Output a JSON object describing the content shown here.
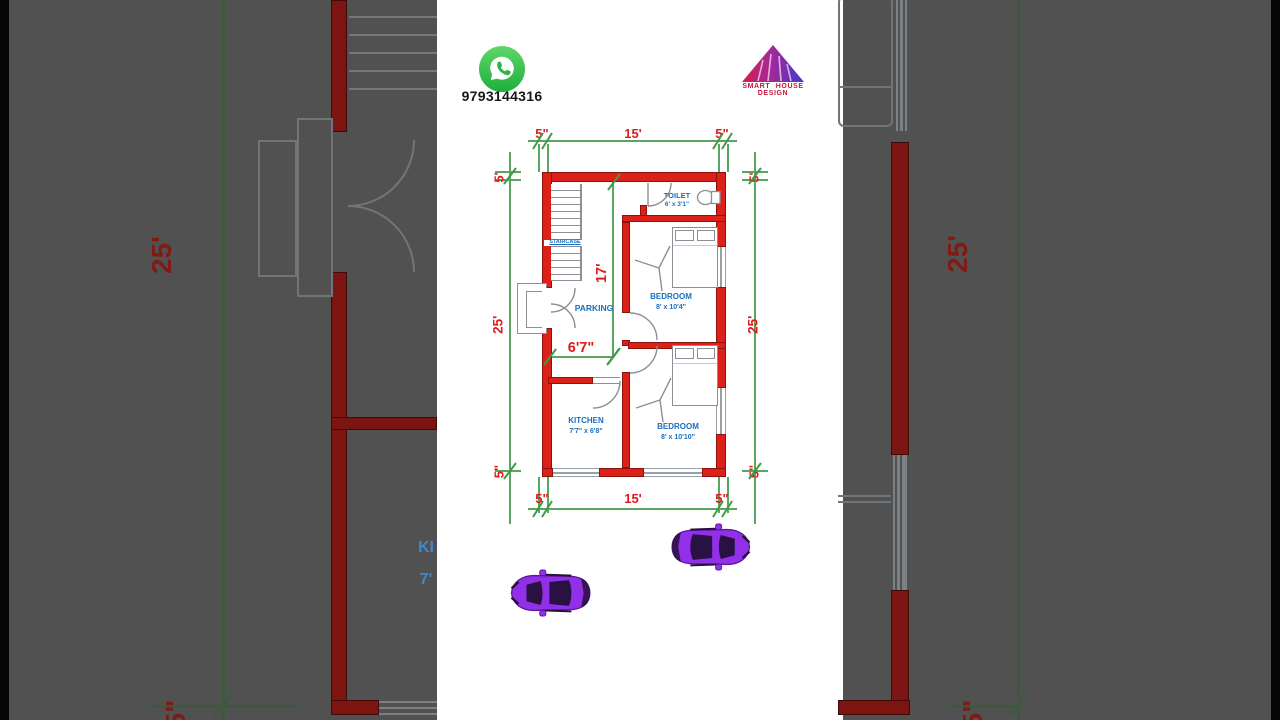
{
  "header": {
    "phone": "9793144316",
    "brand": "SMART HOUSE DESIGN",
    "whatsapp_icon": "whatsapp-icon",
    "logo_icon": "house-roof-logo"
  },
  "plan": {
    "dims": {
      "top_left": "5\"",
      "top_mid": "15'",
      "top_right": "5\"",
      "bottom_left": "5\"",
      "bottom_mid": "15'",
      "bottom_right": "5\"",
      "left_top": "5'",
      "left_mid": "25'",
      "left_bottom": "5\"",
      "right_top": "5'",
      "right_mid": "25'",
      "right_bottom": "5\"",
      "parking_depth": "17'",
      "parking_width": "6'7\""
    },
    "rooms": {
      "toilet": {
        "name": "TOILET",
        "size": "6' x 3'1\""
      },
      "bedroom1": {
        "name": "BEDROOM",
        "size": "8' x 10'4\""
      },
      "bedroom2": {
        "name": "BEDROOM",
        "size": "8' x 10'10\""
      },
      "kitchen": {
        "name": "KITCHEN",
        "size": "7'7\" x 6'8\""
      },
      "parking": {
        "name": "PARKING"
      },
      "staircase": {
        "name": "STAIRCASE"
      }
    }
  },
  "background": {
    "left": {
      "dim_mid": "25'",
      "dim_bottom": "5\"",
      "kitchen_fragment": "KI",
      "kitchen_size_fragment": "7'"
    },
    "right": {
      "dim_mid": "25'",
      "dim_bottom": "5\""
    }
  },
  "colors": {
    "wall_red": "#dd2118",
    "dim_text_red": "#e0191c",
    "dim_line_green": "#5aa55f",
    "room_label_blue": "#1a6ec2",
    "brand_crimson": "#c2183f",
    "whatsapp_green": "#25d366",
    "car_purple": "#9130e8",
    "side_panel_gray": "#515151"
  }
}
